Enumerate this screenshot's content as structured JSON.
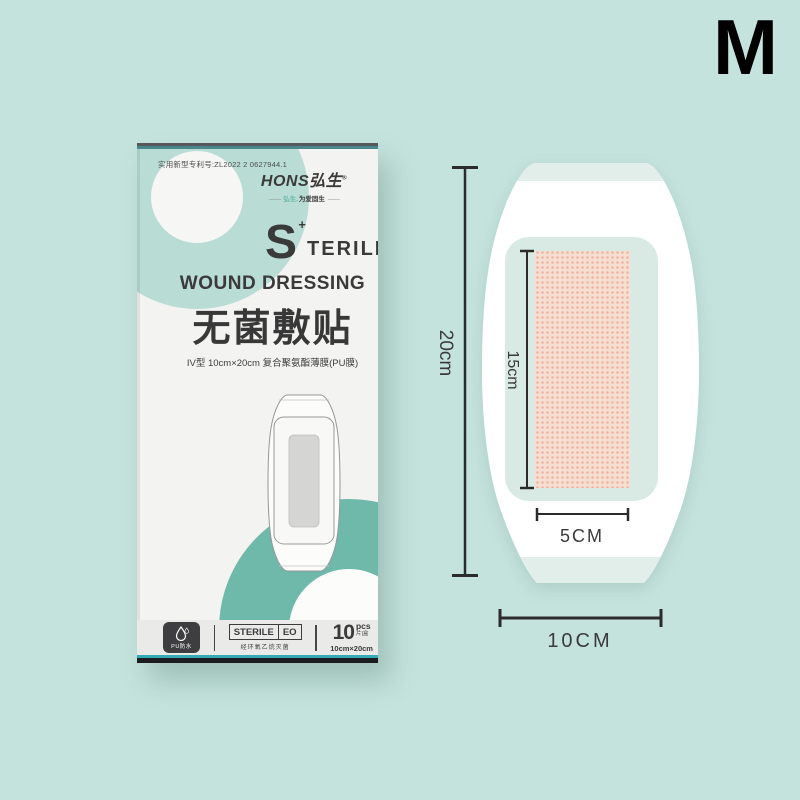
{
  "page": {
    "background": "#c5e3dd",
    "size_label": "M"
  },
  "box": {
    "patent": "实用新型专利号:ZL2022 2 0627944.1",
    "logo": {
      "brand": "HONS弘生",
      "reg": "®",
      "dash": "——",
      "tagline_brand": "弘生,",
      "tagline_rest": "为爱固生"
    },
    "title": {
      "s_initial": "S",
      "plus_mark": "+",
      "rest": "TERILE",
      "line2": "WOUND DRESSING",
      "cn": "无菌敷贴",
      "spec": "IV型 10cm×20cm 复合聚氨酯薄膜(PU膜)"
    },
    "footer": {
      "pu_label": "PU防水",
      "sterile_word": "STERILE",
      "eo_word": "EO",
      "eo_caption": "经环氧乙烷灭菌",
      "count_number": "10",
      "count_unit": "pcs",
      "count_cn": "片|盒",
      "count_size": "10cm×20cm"
    }
  },
  "diagram": {
    "dim_height": "20cm",
    "dim_pad_height": "15cm",
    "dim_pad_width": "5CM",
    "dim_width": "10CM",
    "colors": {
      "film": "#d9eae5",
      "tab": "#e1eeea",
      "pad_bg": "#f7ded3",
      "pad_dot": "#eeb29c",
      "teal_ring": "#6fb9ab",
      "light_ring": "#b9dcd5",
      "dim_line": "#2b2b2b"
    }
  }
}
